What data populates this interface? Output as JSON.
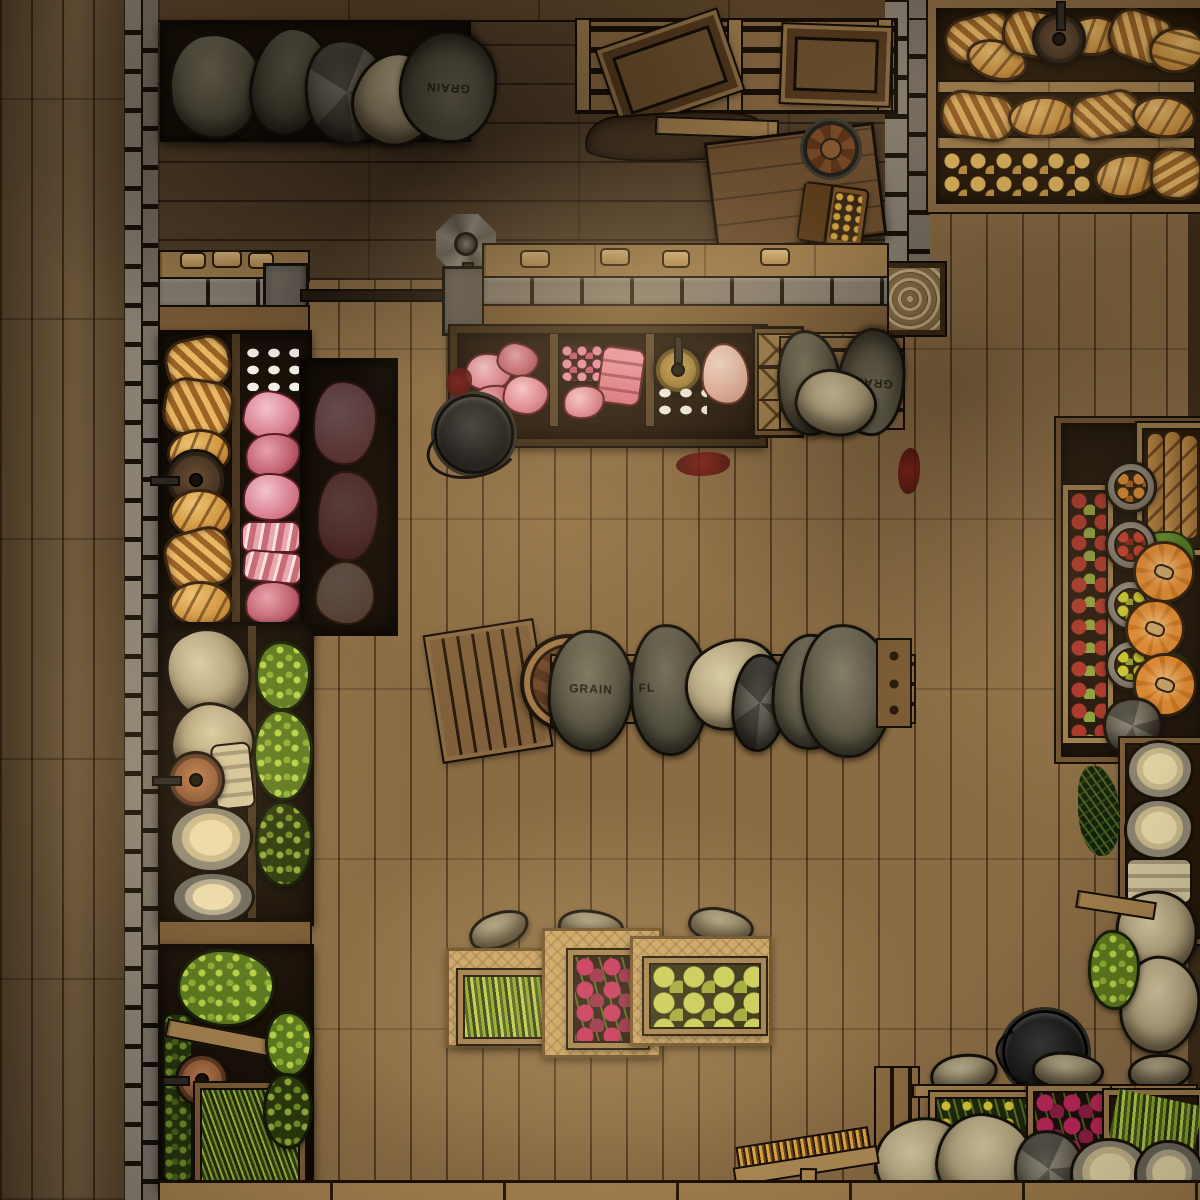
{
  "labels": {
    "grain": "GRAIN",
    "flour": "FL"
  },
  "palette": {
    "floor_outer": "#6b5334",
    "floor_main": "#8a6c44",
    "floor_back": "#54402a",
    "wood_beam": "#5d4529",
    "wood_mid": "#7b5c36",
    "wood_light": "#a3804e",
    "wood_pale": "#c7a468",
    "stone_light": "#8b8274",
    "shelf_bg": "#191108",
    "sack_olive_hi": "#7d7861",
    "sack_olive_lo": "#4a4636",
    "sack_beige_hi": "#d9cda6",
    "sack_beige_lo": "#a08e68",
    "sack_gray_hi": "#8f8b7e",
    "sack_gray_lo": "#514d3e",
    "bread_hi": "#e7b765",
    "bread_lo": "#9c6224",
    "bread_crust": "#3a2410",
    "bun": "#e8bc5f",
    "meat_hi": "#f4c3cc",
    "meat_lo": "#b25563",
    "meat_edge": "#571c23",
    "egg": "#f2efe6",
    "blood": "#7e1414",
    "green_hi": "#b6d348",
    "green_mid": "#8fb032",
    "leaf": "#4c7420",
    "pumpkin_hi": "#e08a33",
    "pumpkin_lo": "#c9741f",
    "tomato": "#c23b2a",
    "orangefruit": "#d98a2e",
    "yellowfruit": "#c9c92e",
    "apple_red": "#a83228",
    "apple_green": "#8aa03c",
    "radish": "#c2285c",
    "artichoke": "#c6cf58",
    "cheese": "#ecdcab",
    "barrel_hi": "#8a5a34",
    "barrel_lo": "#6e4426",
    "brass": "#c9a558",
    "copper": "#c08050"
  },
  "objects": [
    "grain-sack-shelf",
    "top-pallet-bench",
    "lidded-crates",
    "side-table",
    "tankard",
    "coin-satchel",
    "cloth-scrap",
    "bread-shelf",
    "braided-loaves",
    "oval-loaves",
    "bread-rolls",
    "hanging-scales",
    "crank-gear",
    "stone-counter",
    "meat-display",
    "pork-chops",
    "diced-meat",
    "roast",
    "eggs",
    "plucked-chicken",
    "cutting-boards",
    "cauldron",
    "left-bread-and-meat-shelf",
    "hams",
    "bacon",
    "flour-sacks",
    "cheese-wheels",
    "lettuce-crates",
    "green-bean-crate",
    "barrel",
    "sack-row",
    "produce-tables",
    "asparagus-crate",
    "beet-crate",
    "artichoke-crate",
    "right-produce-shelf",
    "apple-crate",
    "fruit-bowls",
    "pumpkins",
    "baguette-crate",
    "herb-crates",
    "bottom-right-stock",
    "radish-crate",
    "broom",
    "stone-walls",
    "plank-floor"
  ]
}
